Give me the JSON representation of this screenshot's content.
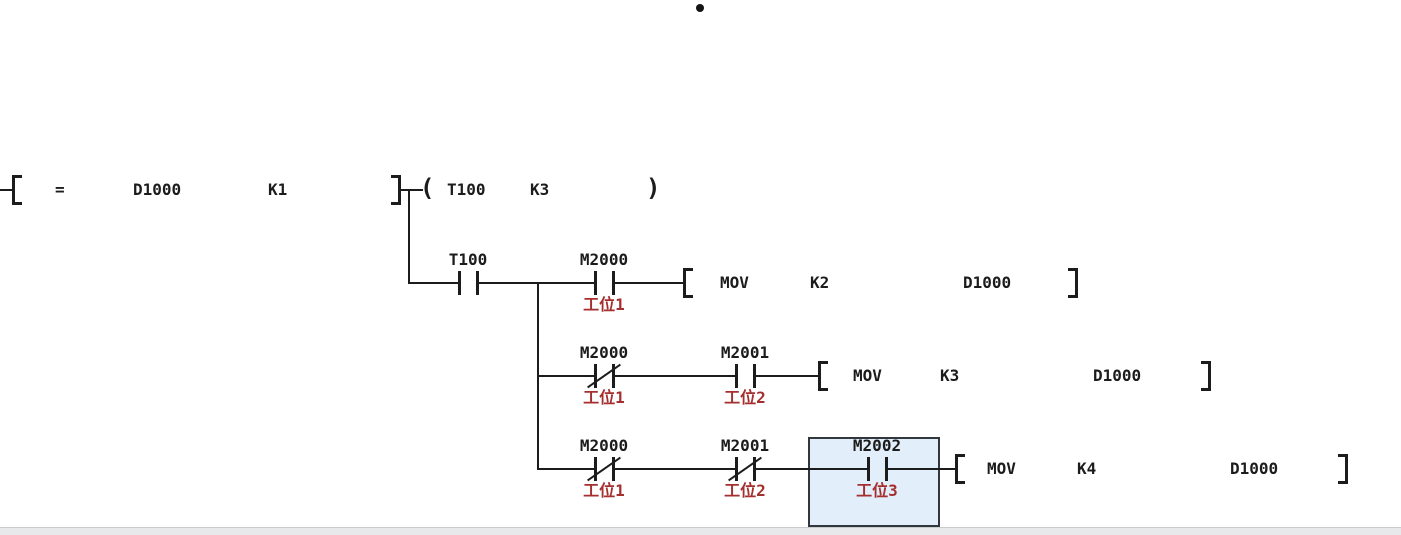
{
  "editor": {
    "background": "#ffffff",
    "bullet": "•"
  },
  "colors": {
    "wire": "#1c1c1c",
    "text": "#1c1c1c",
    "comment_red": "#a52f2f",
    "selection_fill": "#e2eef9",
    "selection_border": "#31373d",
    "statusbar_bg": "#e8e9eb"
  },
  "sym": {
    "open_bracket": "[",
    "close_bracket": "]",
    "open_paren": "(",
    "close_paren": ")"
  },
  "rung1": {
    "compare": {
      "op": "=",
      "arg1": "D1000",
      "arg2": "K1"
    },
    "coil": {
      "device": "T100",
      "preset": "K3"
    }
  },
  "rung2": {
    "t100": {
      "device": "T100",
      "type": "NO",
      "comment": ""
    },
    "m2000": {
      "device": "M2000",
      "type": "NO",
      "comment": "工位1"
    },
    "mov": {
      "op": "MOV",
      "src": "K2",
      "dst": "D1000"
    }
  },
  "rung3": {
    "m2000": {
      "device": "M2000",
      "type": "NC",
      "comment": "工位1"
    },
    "m2001": {
      "device": "M2001",
      "type": "NO",
      "comment": "工位2"
    },
    "mov": {
      "op": "MOV",
      "src": "K3",
      "dst": "D1000"
    }
  },
  "rung4": {
    "m2000": {
      "device": "M2000",
      "type": "NC",
      "comment": "工位1"
    },
    "m2001": {
      "device": "M2001",
      "type": "NC",
      "comment": "工位2"
    },
    "m2002": {
      "device": "M2002",
      "type": "NO",
      "comment": "工位3",
      "selected": true
    },
    "mov": {
      "op": "MOV",
      "src": "K4",
      "dst": "D1000"
    }
  }
}
